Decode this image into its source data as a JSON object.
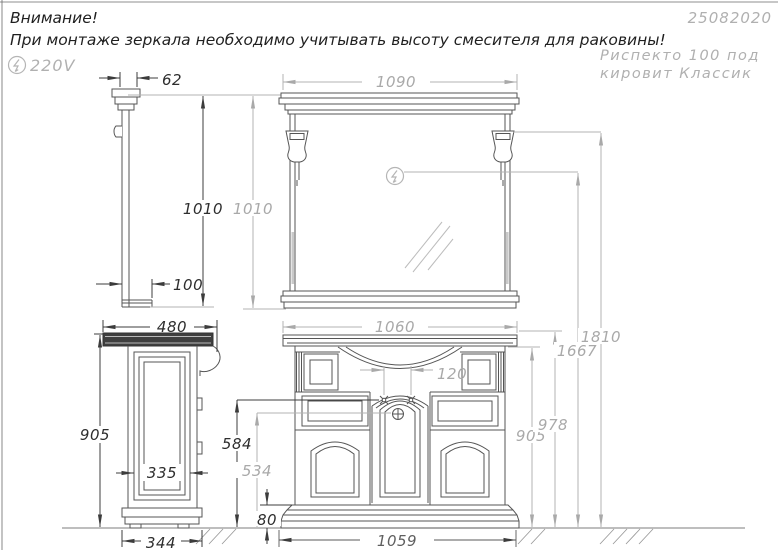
{
  "header": {
    "warning_title": "Внимание!",
    "warning_line": "При монтаже зеркала необходимо учитывать высоту смесителя для раковины!",
    "doc_number": "25082020",
    "product_line1": "Риспекто 100 под",
    "product_line2": "кировит Классик",
    "voltage": "220V"
  },
  "dims": {
    "mirror_profile_width": "62",
    "mirror_front_width": "1090",
    "mirror_side_height": "1010",
    "mirror_front_height": "1010",
    "mirror_shelf_depth": "100",
    "cabinet_depth": "480",
    "countertop_width": "1060",
    "faucet_holes_spacing": "120",
    "cabinet_side_height": "905",
    "side_panel_width": "335",
    "side_base_width": "344",
    "faucet_axis_height": "584",
    "drain_axis_height": "534",
    "plinth_height": "80",
    "base_width": "1059",
    "cabinet_front_height": "905",
    "countertop_top_height": "978",
    "outlet_height": "1667",
    "sconce_top_height": "1810"
  },
  "colors": {
    "dark_line": "#3c3c3c",
    "light_line": "#b3b3b3",
    "dark_text": "#2e2e2e",
    "light_text": "#a9a9a9",
    "counter_fill": "#3f3f3f"
  }
}
